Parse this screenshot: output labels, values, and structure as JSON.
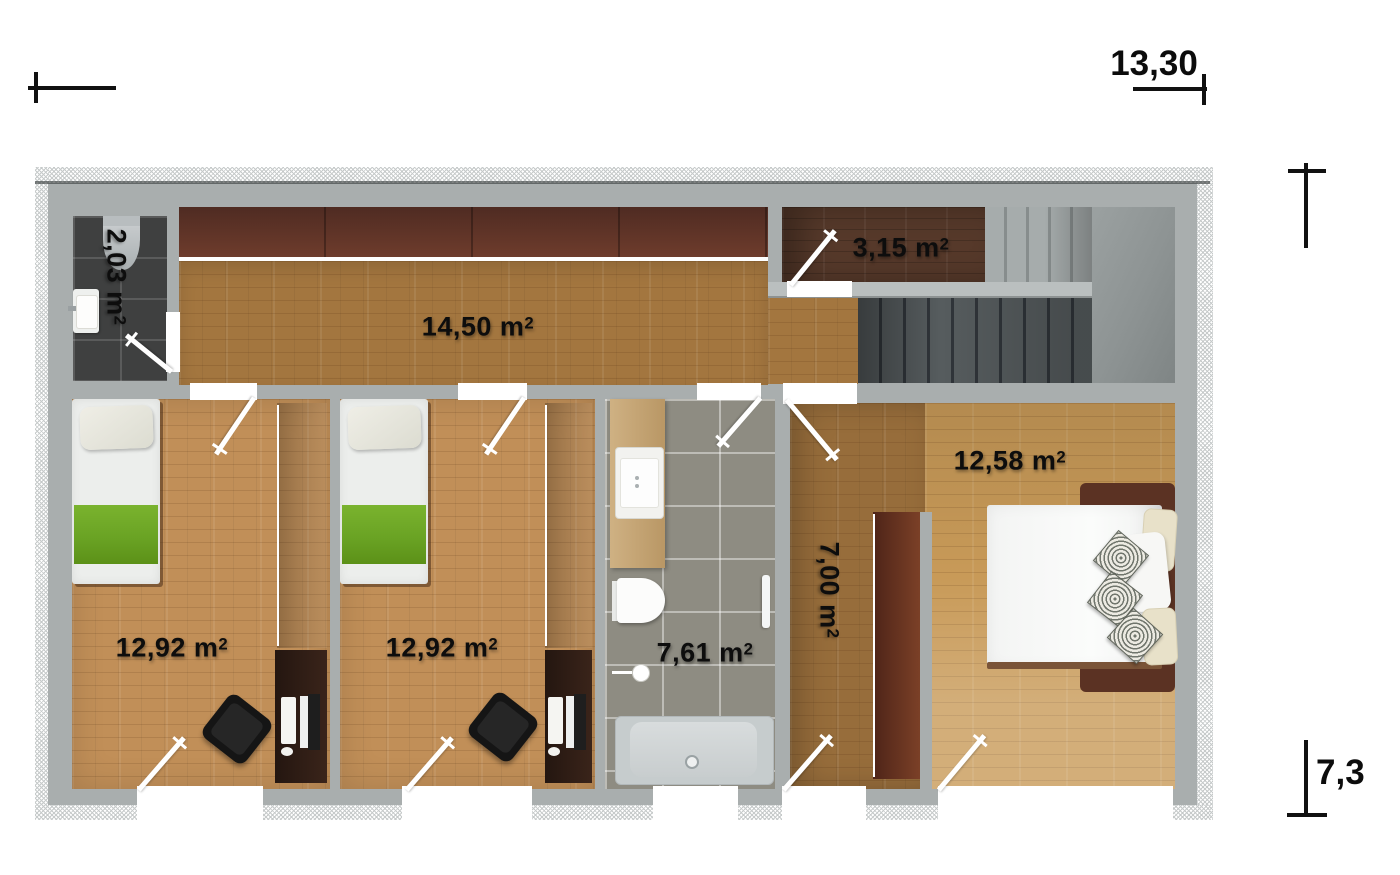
{
  "dimensions": {
    "horizontal": "13,30",
    "vertical": "7,3"
  },
  "rooms": {
    "wc": {
      "area": "2,03 m",
      "sup": "2"
    },
    "hallway": {
      "area": "14,50 m",
      "sup": "2"
    },
    "stair_landing": {
      "area": "3,15 m",
      "sup": "2"
    },
    "bedroom_left": {
      "area": "12,92 m",
      "sup": "2"
    },
    "bedroom_middle": {
      "area": "12,92 m",
      "sup": "2"
    },
    "bathroom": {
      "area": "7,61 m",
      "sup": "2"
    },
    "dressing_corridor": {
      "area": "7,00 m",
      "sup": "2"
    },
    "master_bedroom": {
      "area": "12,58 m",
      "sup": "2"
    }
  },
  "colors": {
    "wall": "#a9aeae",
    "floor_hall": "#a3763f",
    "floor_bedroom": "#c18f58",
    "floor_master": "#c89a58",
    "floor_dark_wood": "#56392a",
    "blanket_green": "#6da32b",
    "wardrobe_brown": "#6e3a26",
    "tile_dark": "#3f4040",
    "tile_taupe": "#8e8c82",
    "stairs_dark": "#4c5254",
    "stairs_light": "#989e9e"
  }
}
